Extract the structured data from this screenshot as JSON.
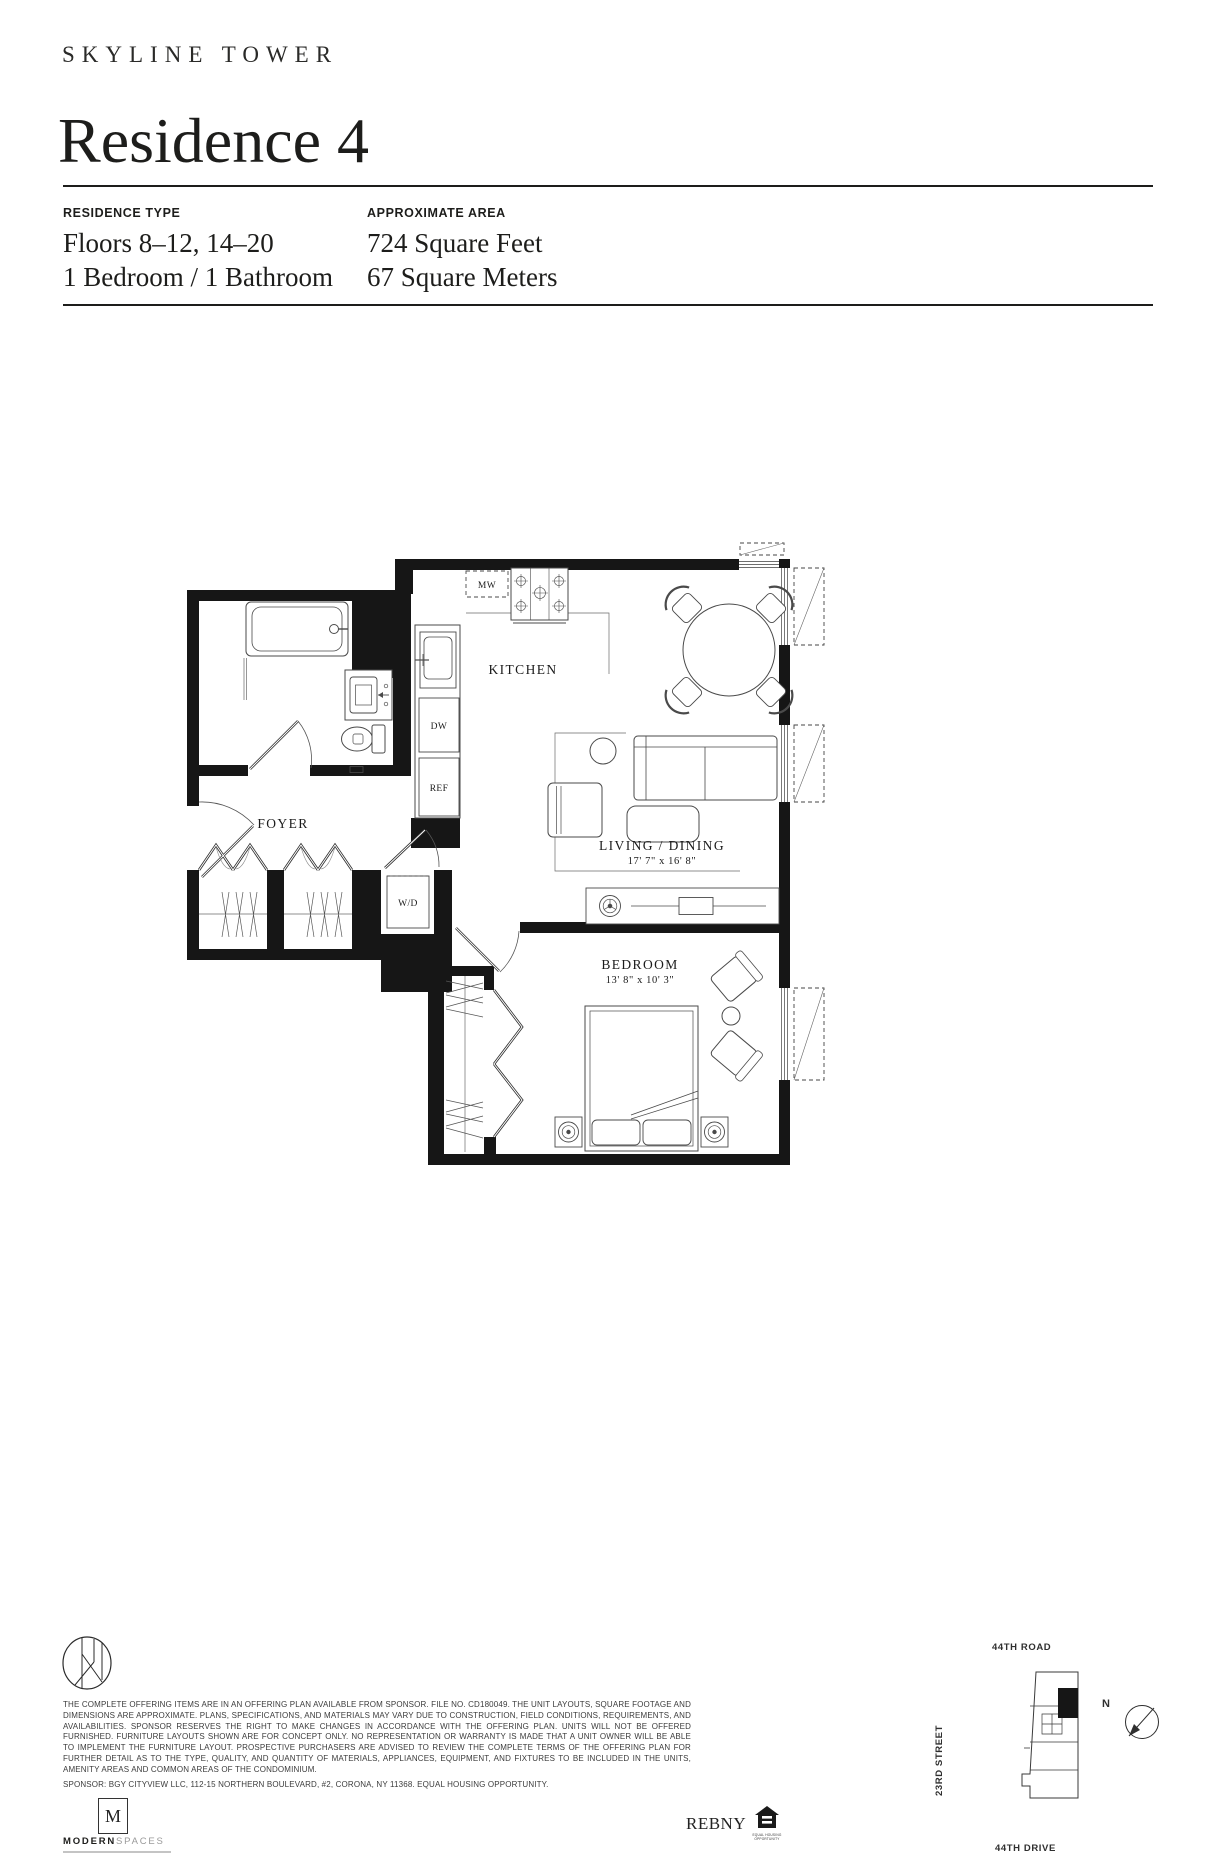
{
  "colors": {
    "ink": "#1d1d1b",
    "wall": "#161616"
  },
  "brand": {
    "name": "SKYLINE TOWER"
  },
  "header": {
    "title": "Residence 4"
  },
  "specs": {
    "residence_type": {
      "label": "RESIDENCE TYPE",
      "lines": [
        "Floors 8–12, 14–20",
        "1 Bedroom / 1 Bathroom"
      ]
    },
    "approximate_area": {
      "label": "APPROXIMATE AREA",
      "lines": [
        "724 Square Feet",
        "67 Square Meters"
      ]
    }
  },
  "floorplan": {
    "labels": {
      "kitchen": "KITCHEN",
      "foyer": "FOYER",
      "living_dining": "LIVING / DINING",
      "living_dining_dims": "17' 7\" x 16' 8\"",
      "bedroom": "BEDROOM",
      "bedroom_dims": "13' 8\" x 10' 3\"",
      "microwave": "MW",
      "dishwasher": "DW",
      "refrigerator": "REF",
      "washer_dryer": "W/D"
    }
  },
  "footer": {
    "disclaimer": "THE COMPLETE OFFERING ITEMS ARE IN AN OFFERING PLAN AVAILABLE FROM SPONSOR. FILE NO. CD180049. THE UNIT LAYOUTS, SQUARE FOOTAGE AND DIMENSIONS ARE APPROXIMATE. PLANS, SPECIFICATIONS, AND MATERIALS MAY VARY DUE TO CONSTRUCTION, FIELD CONDITIONS, REQUIREMENTS, AND AVAILABILITIES. SPONSOR RESERVES THE RIGHT TO MAKE CHANGES IN ACCORDANCE WITH THE OFFERING PLAN. UNITS WILL NOT BE OFFERED FURNISHED. FURNITURE LAYOUTS SHOWN ARE FOR CONCEPT ONLY. NO REPRESENTATION OR WARRANTY IS MADE THAT A UNIT OWNER WILL BE ABLE TO IMPLEMENT THE FURNITURE LAYOUT. PROSPECTIVE PURCHASERS ARE ADVISED TO REVIEW THE COMPLETE TERMS OF THE OFFERING PLAN FOR FURTHER DETAIL AS TO THE TYPE, QUALITY, AND QUANTITY OF MATERIALS, APPLIANCES, EQUIPMENT, AND FIXTURES TO BE INCLUDED IN THE UNITS, AMENITY AREAS AND COMMON AREAS OF THE CONDOMINIUM.",
    "sponsor": "SPONSOR: BGY CITYVIEW LLC, 112-15 NORTHERN BOULEVARD, #2, CORONA, NY 11368. EQUAL HOUSING OPPORTUNITY.",
    "logos": {
      "modern_m": "M",
      "modern_bold": "MODERN",
      "modern_light": "SPACES",
      "rebny": "REBNY",
      "equal_housing_caption": "EQUAL HOUSING OPPORTUNITY"
    },
    "map": {
      "road_top": "44TH ROAD",
      "street_left": "23RD STREET",
      "road_bottom": "44TH DRIVE",
      "north": "N"
    }
  }
}
